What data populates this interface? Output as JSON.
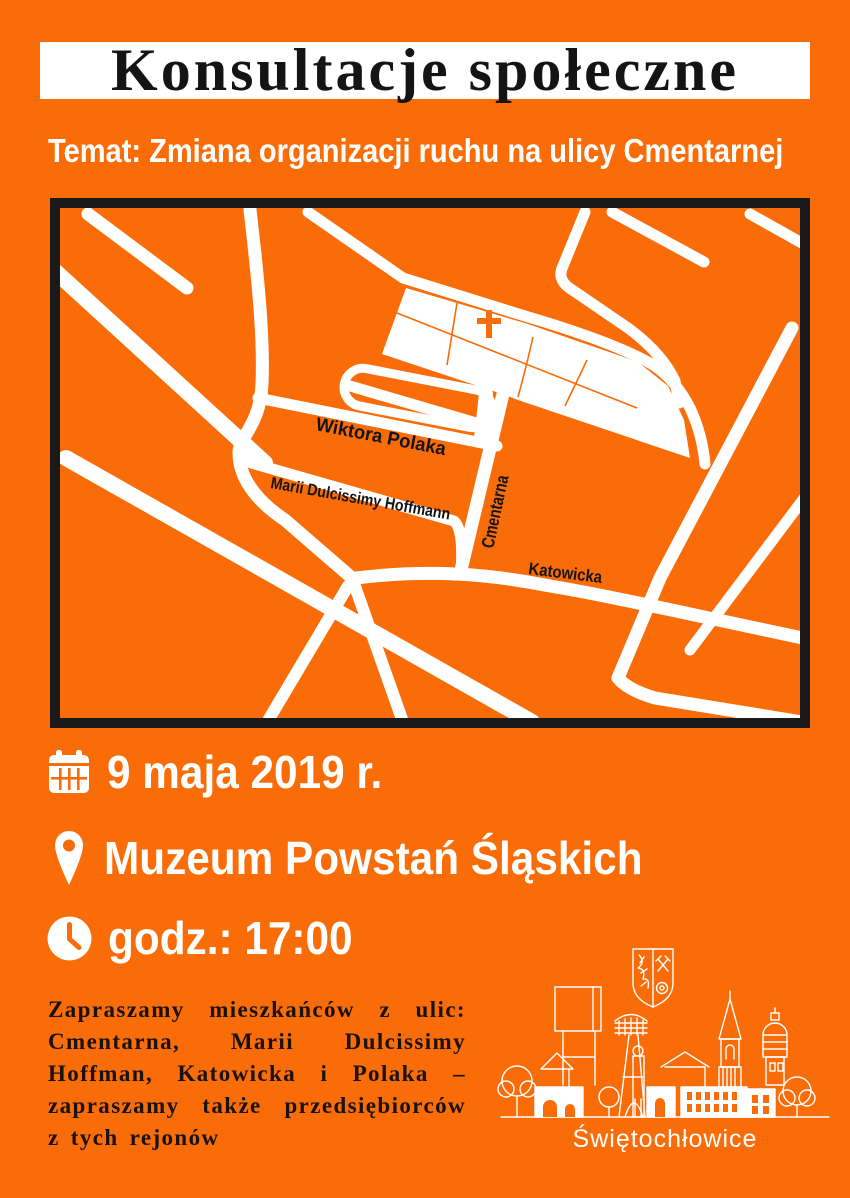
{
  "colors": {
    "background": "#F96C07",
    "frame_black": "#1A1A1A",
    "white": "#FFFFFF",
    "text_dark": "#141414"
  },
  "header": {
    "title": "Konsultacje społeczne",
    "subtitle": "Temat: Zmiana organizacji ruchu na ulicy Cmentarnej"
  },
  "map": {
    "street_labels": [
      {
        "label": "Wiktora Polaka"
      },
      {
        "label": "Marii Dulcissimy Hoffmann"
      },
      {
        "label": "Cmentarna"
      },
      {
        "label": "Katowicka"
      }
    ],
    "icons": [
      {
        "name": "cemetery-cross-icon",
        "glyph": "†",
        "color": "#F96C07"
      }
    ]
  },
  "details": {
    "items": [
      {
        "icon": "calendar-icon",
        "text": "9 maja 2019 r."
      },
      {
        "icon": "location-pin-icon",
        "text": "Muzeum Powstań Śląskich"
      },
      {
        "icon": "clock-icon",
        "text": "godz.: 17:00"
      }
    ]
  },
  "invitation": {
    "text": "Zapraszamy mieszkańców z ulic: Cmentarna, Marii Dulcissimy Hoffman, Katowicka i Polaka – zapraszamy także przedsiębiorców z tych rejonów",
    "lines": [
      "Zapraszamy mieszkańców z ulic:",
      "Cmentarna, Marii Dulcissimy",
      "Hoffman, Katowicka i Polaka –",
      "zapraszamy także przedsiębiorców",
      "z tych rejonów"
    ]
  },
  "footer": {
    "city": "Świętochłowice"
  }
}
